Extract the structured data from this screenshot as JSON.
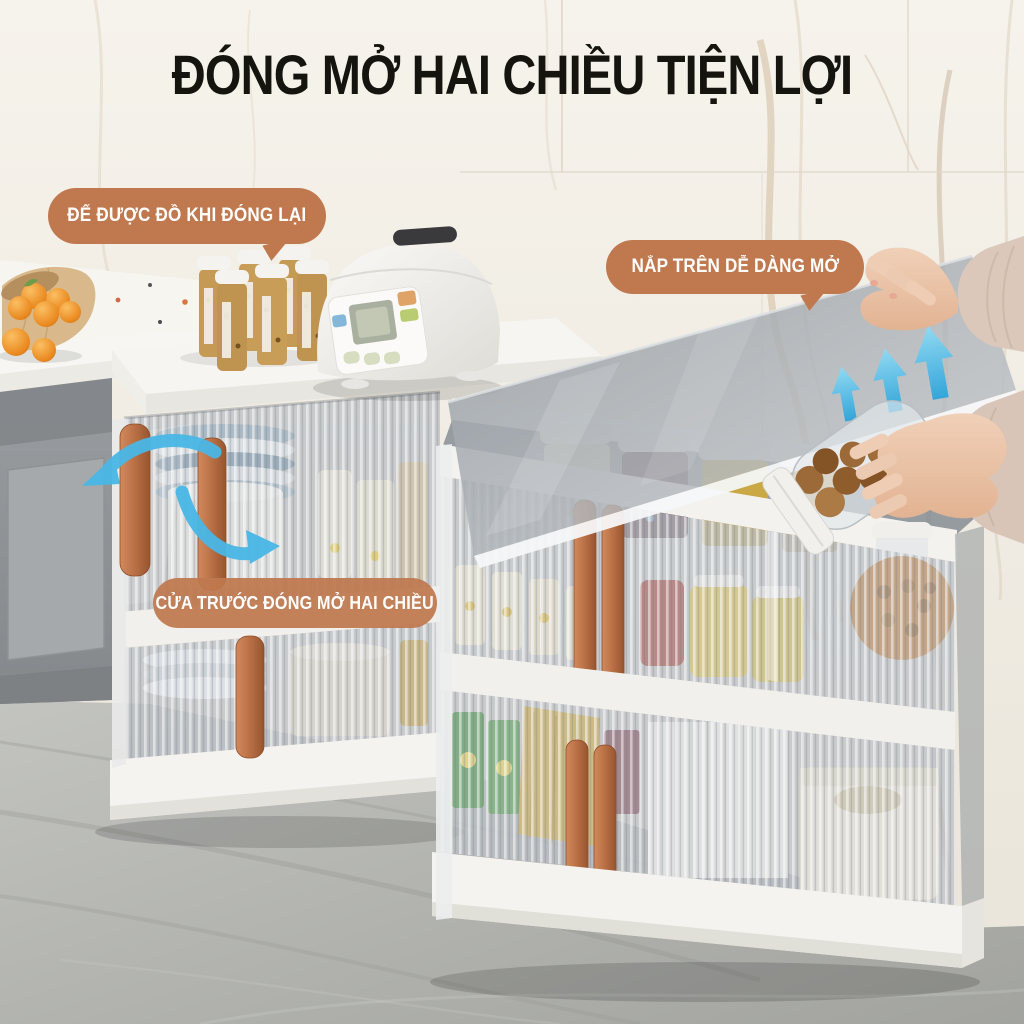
{
  "banner": {
    "title": "ĐÓNG MỞ HAI CHIỀU TIỆN LỢI"
  },
  "callouts": {
    "closed_storage": "ĐỂ ĐƯỢC ĐỒ KHI ĐÓNG LẠI",
    "top_lid": "NẮP TRÊN DỄ DÀNG MỞ",
    "front_door": "CỬA TRƯỚC ĐÓNG MỞ HAI CHIỀU"
  },
  "icons": {
    "lid_open": "triple-up-arrow",
    "door_swing_out": "curved-arrow-left",
    "door_swing_in": "curved-arrow-right"
  },
  "colors": {
    "callout_bg": "#c0794f",
    "callout_text": "#ffffff",
    "title_text": "#16140f",
    "arrow_blue": "#49b7e6",
    "handle_terracotta": "#b96f45"
  }
}
